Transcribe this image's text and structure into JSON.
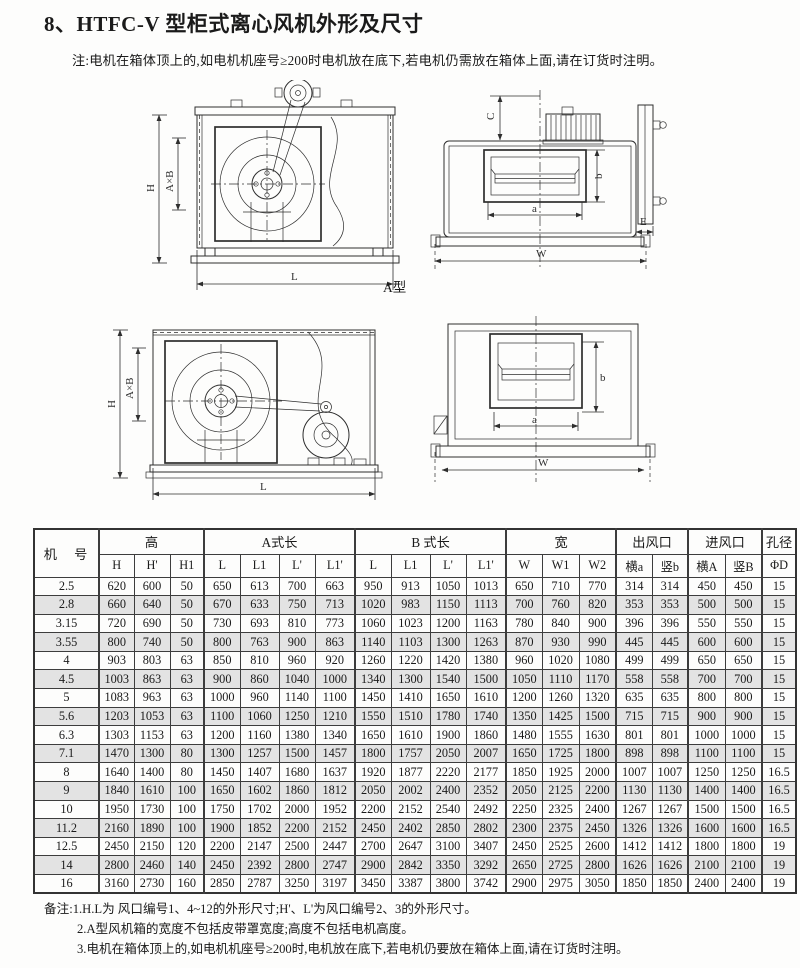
{
  "page": {
    "title": "8、HTFC-V 型柜式离心风机外形及尺寸",
    "note": "注:电机在箱体顶上的,如电机机座号≥200时电机放在底下,若电机仍需放在箱体上面,请在订货时注明。"
  },
  "colors": {
    "paper": "#fdfdfc",
    "ink": "#1a1a1a",
    "table_stripe": "#e3e3e3",
    "line": "#2e2e2e"
  },
  "drawings": {
    "type_a_label": "A型",
    "dims": {
      "H": "H",
      "AXB": "A×B",
      "L": "L",
      "C": "C",
      "a": "a",
      "b": "b",
      "E": "E",
      "W": "W"
    }
  },
  "table": {
    "machine_label": "机　号",
    "groups": [
      {
        "label": "高"
      },
      {
        "label": "A式长"
      },
      {
        "label": "B 式长"
      },
      {
        "label": "宽"
      },
      {
        "label": "出风口"
      },
      {
        "label": "进风口"
      },
      {
        "label": "孔径"
      }
    ],
    "subheaders": [
      "H",
      "H'",
      "H1",
      "L",
      "L1",
      "L'",
      "L1'",
      "L",
      "L1",
      "L'",
      "L1'",
      "W",
      "W1",
      "W2",
      "横a",
      "竖b",
      "横A",
      "竖B",
      "ΦD"
    ],
    "rows": [
      {
        "model": "2.5",
        "values": [
          "620",
          "600",
          "50",
          "650",
          "613",
          "700",
          "663",
          "950",
          "913",
          "1050",
          "1013",
          "650",
          "710",
          "770",
          "314",
          "314",
          "450",
          "450",
          "15"
        ]
      },
      {
        "model": "2.8",
        "values": [
          "660",
          "640",
          "50",
          "670",
          "633",
          "750",
          "713",
          "1020",
          "983",
          "1150",
          "1113",
          "700",
          "760",
          "820",
          "353",
          "353",
          "500",
          "500",
          "15"
        ]
      },
      {
        "model": "3.15",
        "values": [
          "720",
          "690",
          "50",
          "730",
          "693",
          "810",
          "773",
          "1060",
          "1023",
          "1200",
          "1163",
          "780",
          "840",
          "900",
          "396",
          "396",
          "550",
          "550",
          "15"
        ]
      },
      {
        "model": "3.55",
        "values": [
          "800",
          "740",
          "50",
          "800",
          "763",
          "900",
          "863",
          "1140",
          "1103",
          "1300",
          "1263",
          "870",
          "930",
          "990",
          "445",
          "445",
          "600",
          "600",
          "15"
        ]
      },
      {
        "model": "4",
        "values": [
          "903",
          "803",
          "63",
          "850",
          "810",
          "960",
          "920",
          "1260",
          "1220",
          "1420",
          "1380",
          "960",
          "1020",
          "1080",
          "499",
          "499",
          "650",
          "650",
          "15"
        ]
      },
      {
        "model": "4.5",
        "values": [
          "1003",
          "863",
          "63",
          "900",
          "860",
          "1040",
          "1000",
          "1340",
          "1300",
          "1540",
          "1500",
          "1050",
          "1110",
          "1170",
          "558",
          "558",
          "700",
          "700",
          "15"
        ]
      },
      {
        "model": "5",
        "values": [
          "1083",
          "963",
          "63",
          "1000",
          "960",
          "1140",
          "1100",
          "1450",
          "1410",
          "1650",
          "1610",
          "1200",
          "1260",
          "1320",
          "635",
          "635",
          "800",
          "800",
          "15"
        ]
      },
      {
        "model": "5.6",
        "values": [
          "1203",
          "1053",
          "63",
          "1100",
          "1060",
          "1250",
          "1210",
          "1550",
          "1510",
          "1780",
          "1740",
          "1350",
          "1425",
          "1500",
          "715",
          "715",
          "900",
          "900",
          "15"
        ]
      },
      {
        "model": "6.3",
        "values": [
          "1303",
          "1153",
          "63",
          "1200",
          "1160",
          "1380",
          "1340",
          "1650",
          "1610",
          "1900",
          "1860",
          "1480",
          "1555",
          "1630",
          "801",
          "801",
          "1000",
          "1000",
          "15"
        ]
      },
      {
        "model": "7.1",
        "values": [
          "1470",
          "1300",
          "80",
          "1300",
          "1257",
          "1500",
          "1457",
          "1800",
          "1757",
          "2050",
          "2007",
          "1650",
          "1725",
          "1800",
          "898",
          "898",
          "1100",
          "1100",
          "15"
        ]
      },
      {
        "model": "8",
        "values": [
          "1640",
          "1400",
          "80",
          "1450",
          "1407",
          "1680",
          "1637",
          "1920",
          "1877",
          "2220",
          "2177",
          "1850",
          "1925",
          "2000",
          "1007",
          "1007",
          "1250",
          "1250",
          "16.5"
        ]
      },
      {
        "model": "9",
        "values": [
          "1840",
          "1610",
          "100",
          "1650",
          "1602",
          "1860",
          "1812",
          "2050",
          "2002",
          "2400",
          "2352",
          "2050",
          "2125",
          "2200",
          "1130",
          "1130",
          "1400",
          "1400",
          "16.5"
        ]
      },
      {
        "model": "10",
        "values": [
          "1950",
          "1730",
          "100",
          "1750",
          "1702",
          "2000",
          "1952",
          "2200",
          "2152",
          "2540",
          "2492",
          "2250",
          "2325",
          "2400",
          "1267",
          "1267",
          "1500",
          "1500",
          "16.5"
        ]
      },
      {
        "model": "11.2",
        "values": [
          "2160",
          "1890",
          "100",
          "1900",
          "1852",
          "2200",
          "2152",
          "2450",
          "2402",
          "2850",
          "2802",
          "2300",
          "2375",
          "2450",
          "1326",
          "1326",
          "1600",
          "1600",
          "16.5"
        ]
      },
      {
        "model": "12.5",
        "values": [
          "2450",
          "2150",
          "120",
          "2200",
          "2147",
          "2500",
          "2447",
          "2700",
          "2647",
          "3100",
          "3407",
          "2450",
          "2525",
          "2600",
          "1412",
          "1412",
          "1800",
          "1800",
          "19"
        ]
      },
      {
        "model": "14",
        "values": [
          "2800",
          "2460",
          "140",
          "2450",
          "2392",
          "2800",
          "2747",
          "2900",
          "2842",
          "3350",
          "3292",
          "2650",
          "2725",
          "2800",
          "1626",
          "1626",
          "2100",
          "2100",
          "19"
        ]
      },
      {
        "model": "16",
        "values": [
          "3160",
          "2730",
          "160",
          "2850",
          "2787",
          "3250",
          "3197",
          "3450",
          "3387",
          "3800",
          "3742",
          "2900",
          "2975",
          "3050",
          "1850",
          "1850",
          "2400",
          "2400",
          "19"
        ]
      }
    ]
  },
  "footnotes": {
    "label": "备注:",
    "items": [
      "1.H.L为 风口编号1、4~12的外形尺寸;H'、L'为风口编号2、3的外形尺寸。",
      "2.A型风机箱的宽度不包括皮带罩宽度;高度不包括电机高度。",
      "3.电机在箱体顶上的,如电机机座号≥200时,电机放在底下,若电机仍要放在箱体上面,请在订货时注明。"
    ]
  }
}
